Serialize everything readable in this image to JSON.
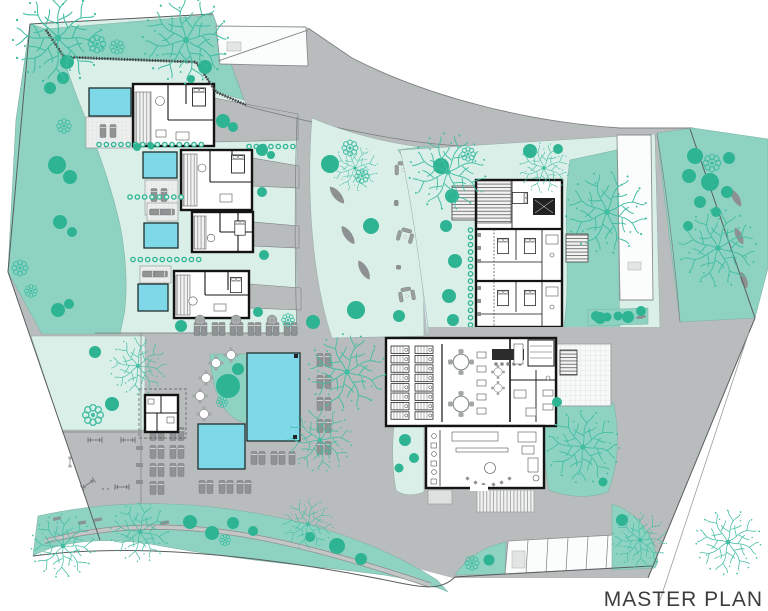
{
  "title_block": {
    "label": "MASTER PLAN"
  },
  "palette": {
    "background": "#ffffff",
    "landscape_teal": "#8ed2c2",
    "lawn_mint": "#d9efe8",
    "stream_blue": "#d9edf1",
    "road_gray": "#b9bcbc",
    "pavement_light": "#fbfcfc",
    "furniture_gray": "#8d9191",
    "pool_blue": "#7ed8e8",
    "building_wall": "#141414",
    "building_fill": "#ffffff",
    "shrub_green": "#2eb493",
    "tree_outline": "#41bda2",
    "boundary_line": "#5a5e5e",
    "title_color": "#3d3d3d"
  },
  "legend": [
    {
      "name": "private-villa-with-pool",
      "count": 4
    },
    {
      "name": "townhouse-block-units",
      "count": 3
    },
    {
      "name": "clubhouse-restaurant-spa",
      "count": 1
    },
    {
      "name": "main-swimming-pool",
      "count": 1
    },
    {
      "name": "children-pool",
      "count": 1
    },
    {
      "name": "parking-stalls",
      "count": 7
    },
    {
      "name": "outdoor-gym",
      "count": 1
    },
    {
      "name": "garden-lounge-areas",
      "count": 3
    }
  ]
}
